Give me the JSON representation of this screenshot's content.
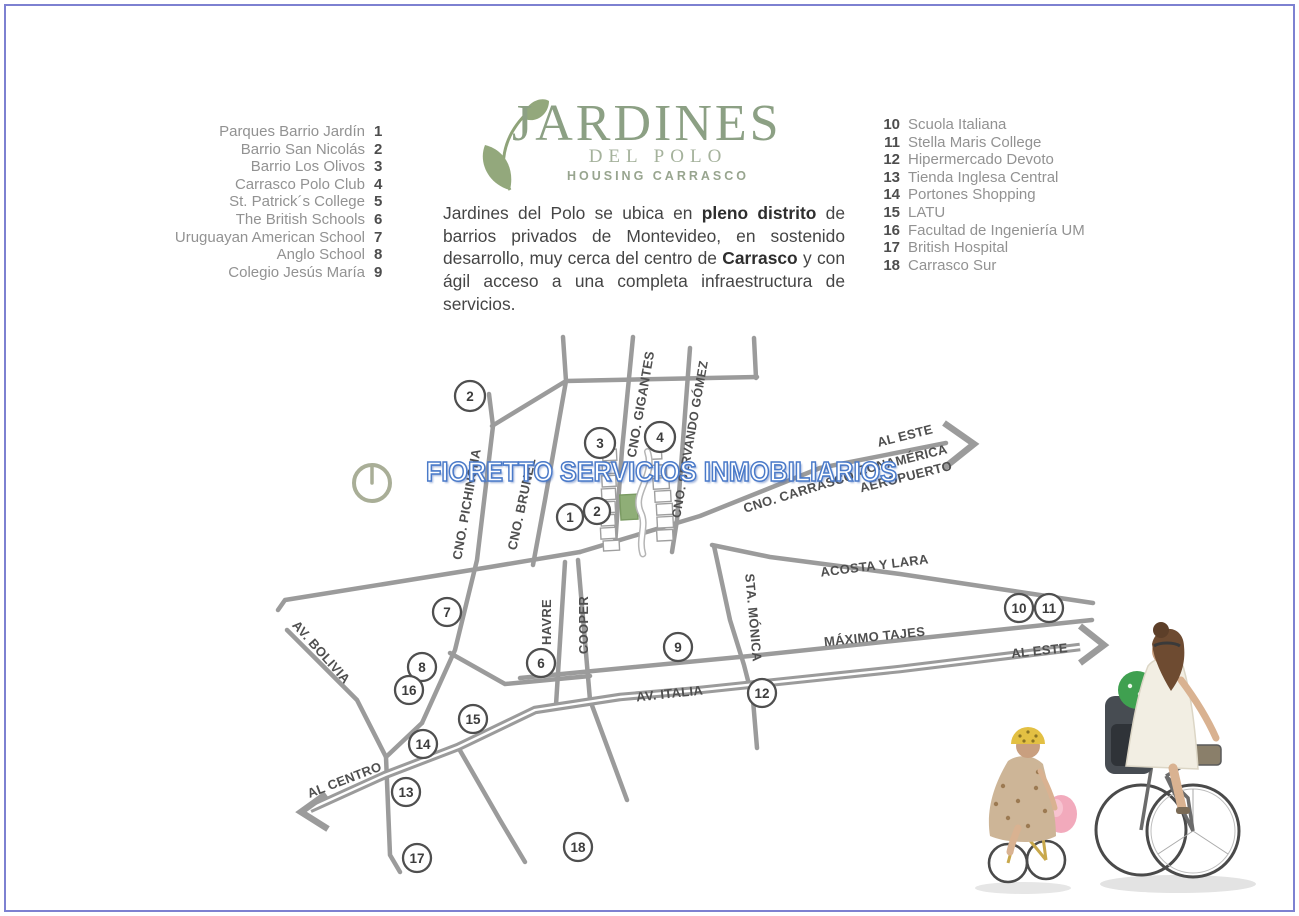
{
  "colors": {
    "border": "#7d81d1",
    "accent_green": "#8ca084",
    "leaf_green": "#93a87c",
    "road": "#9b9b9b",
    "map_label": "#4f4f4f",
    "legend_name": "#929292",
    "legend_num": "#4d4d4d",
    "watermark_blue": "#4a7ac9",
    "lot_green": "#8fae77"
  },
  "logo": {
    "title": "JARDINES",
    "subtitle": "DEL POLO",
    "tagline": "HOUSING CARRASCO"
  },
  "intro": {
    "segments": [
      {
        "text": "Jardines del Polo se ubica en ",
        "bold": false
      },
      {
        "text": "pleno distrito",
        "bold": true
      },
      {
        "text": " de barrios privados de Montevideo, en sostenido desarrollo, muy cerca del centro de ",
        "bold": false
      },
      {
        "text": "Carrasco",
        "bold": true
      },
      {
        "text": " y con ágil acceso a una completa infraestructura de servicios.",
        "bold": false
      }
    ]
  },
  "legend_left": {
    "items": [
      {
        "num": "1",
        "label": "Parques Barrio Jardín"
      },
      {
        "num": "2",
        "label": "Barrio San Nicolás"
      },
      {
        "num": "3",
        "label": "Barrio Los Olivos"
      },
      {
        "num": "4",
        "label": "Carrasco Polo Club"
      },
      {
        "num": "5",
        "label": "St. Patrick´s College"
      },
      {
        "num": "6",
        "label": "The British Schools"
      },
      {
        "num": "7",
        "label": "Uruguayan American School"
      },
      {
        "num": "8",
        "label": "Anglo School"
      },
      {
        "num": "9",
        "label": "Colegio Jesús María"
      }
    ]
  },
  "legend_right": {
    "items": [
      {
        "num": "10",
        "label": "Scuola Italiana"
      },
      {
        "num": "11",
        "label": "Stella Maris College"
      },
      {
        "num": "12",
        "label": "Hipermercado Devoto"
      },
      {
        "num": "13",
        "label": "Tienda Inglesa Central"
      },
      {
        "num": "14",
        "label": "Portones Shopping"
      },
      {
        "num": "15",
        "label": "LATU"
      },
      {
        "num": "16",
        "label": "Facultad de Ingeniería UM"
      },
      {
        "num": "17",
        "label": "British Hospital"
      },
      {
        "num": "18",
        "label": "Carrasco Sur"
      }
    ]
  },
  "watermark": {
    "text": "FIORETTO SERVICIOS INMOBILIARIOS"
  },
  "map": {
    "street_labels": [
      {
        "text": "CNO. PICHINCHA",
        "x": 471,
        "y": 505,
        "rot": -80
      },
      {
        "text": "CNO. BRUNEL",
        "x": 526,
        "y": 505,
        "rot": -78
      },
      {
        "text": "CNO. GIGANTES",
        "x": 645,
        "y": 405,
        "rot": -80
      },
      {
        "text": "CNO. SERVANDO GÓMEZ",
        "x": 694,
        "y": 440,
        "rot": -80,
        "size": 12.5
      },
      {
        "text": "CNO. CARRASCO",
        "x": 800,
        "y": 496,
        "rot": -17
      },
      {
        "text": "AL ESTE",
        "x": 906,
        "y": 440,
        "rot": -14
      },
      {
        "text": "ZONAMÉRICA",
        "x": 904,
        "y": 464,
        "rot": -14
      },
      {
        "text": "AEROPUERTO",
        "x": 907,
        "y": 481,
        "rot": -14
      },
      {
        "text": "ACOSTA Y LARA",
        "x": 875,
        "y": 570,
        "rot": -7
      },
      {
        "text": "MÁXIMO TAJES",
        "x": 875,
        "y": 641,
        "rot": -6
      },
      {
        "text": "AL ESTE",
        "x": 1040,
        "y": 655,
        "rot": -6
      },
      {
        "text": "AV. ITALIA",
        "x": 670,
        "y": 698,
        "rot": -6
      },
      {
        "text": "HAVRE",
        "x": 551,
        "y": 622,
        "rot": -90
      },
      {
        "text": "COOPER",
        "x": 588,
        "y": 625,
        "rot": -90
      },
      {
        "text": "STA. MÓNICA",
        "x": 749,
        "y": 618,
        "rot": 85
      },
      {
        "text": "AV. BOLIVIA",
        "x": 318,
        "y": 655,
        "rot": 48
      },
      {
        "text": "AL CENTRO",
        "x": 346,
        "y": 784,
        "rot": -21
      }
    ],
    "markers": [
      {
        "num": "2",
        "x": 470,
        "y": 396,
        "r": 15
      },
      {
        "num": "3",
        "x": 600,
        "y": 443,
        "r": 15
      },
      {
        "num": "4",
        "x": 660,
        "y": 437,
        "r": 15
      },
      {
        "num": "1",
        "x": 570,
        "y": 517,
        "r": 13
      },
      {
        "num": "2",
        "x": 597,
        "y": 511,
        "r": 13
      },
      {
        "num": "7",
        "x": 447,
        "y": 612,
        "r": 14
      },
      {
        "num": "8",
        "x": 422,
        "y": 667,
        "r": 14
      },
      {
        "num": "16",
        "x": 409,
        "y": 690,
        "r": 14
      },
      {
        "num": "6",
        "x": 541,
        "y": 663,
        "r": 14
      },
      {
        "num": "9",
        "x": 678,
        "y": 647,
        "r": 14
      },
      {
        "num": "10",
        "x": 1019,
        "y": 608,
        "r": 14
      },
      {
        "num": "11",
        "x": 1049,
        "y": 608,
        "r": 14
      },
      {
        "num": "12",
        "x": 762,
        "y": 693,
        "r": 14
      },
      {
        "num": "15",
        "x": 473,
        "y": 719,
        "r": 14
      },
      {
        "num": "14",
        "x": 423,
        "y": 744,
        "r": 14
      },
      {
        "num": "13",
        "x": 406,
        "y": 792,
        "r": 14
      },
      {
        "num": "17",
        "x": 417,
        "y": 858,
        "r": 14
      },
      {
        "num": "18",
        "x": 578,
        "y": 847,
        "r": 14
      }
    ]
  }
}
